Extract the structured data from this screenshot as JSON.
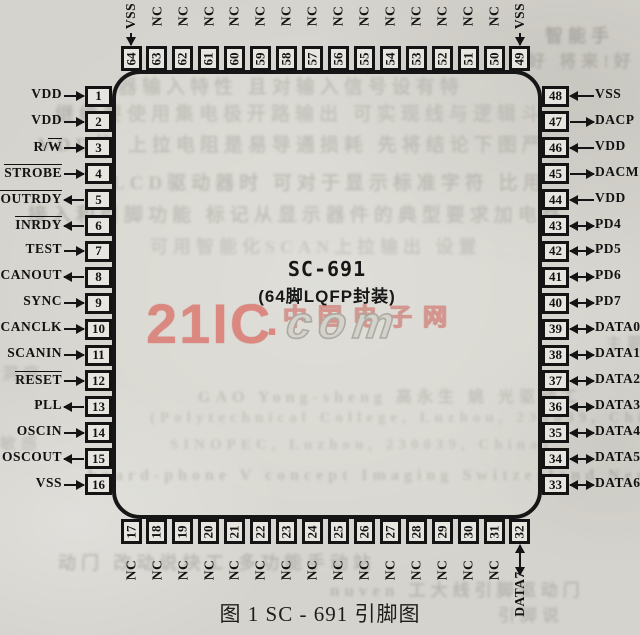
{
  "figure": {
    "chip_name": "SC-691",
    "package_label": "(64脚LQFP封装)",
    "caption": "图 1  SC - 691 引脚图"
  },
  "watermark": {
    "logo": "21IC",
    "dot": ".",
    "suffix": "com",
    "cn": "中国电子网",
    "red": "#d96a62",
    "gray": "#a5a39e"
  },
  "colors": {
    "paper": "#d5d3cd",
    "ink": "#141414",
    "pin_fill": "#e7e5df"
  },
  "pins": {
    "left": [
      {
        "num": "1",
        "pre": "VDD",
        "over": "",
        "dir": "in"
      },
      {
        "num": "2",
        "pre": "VDD",
        "over": "",
        "dir": "in"
      },
      {
        "num": "3",
        "pre": "R/",
        "over": "W",
        "dir": "in"
      },
      {
        "num": "4",
        "pre": "",
        "over": "STROBE",
        "dir": "in"
      },
      {
        "num": "5",
        "pre": "",
        "over": "OUTRDY",
        "dir": "out"
      },
      {
        "num": "6",
        "pre": "",
        "over": "INRDY",
        "dir": "out"
      },
      {
        "num": "7",
        "pre": "TEST",
        "over": "",
        "dir": "in"
      },
      {
        "num": "8",
        "pre": "SCANOUT",
        "over": "",
        "dir": "out"
      },
      {
        "num": "9",
        "pre": "SYNC",
        "over": "",
        "dir": "in"
      },
      {
        "num": "10",
        "pre": "SCANCLK",
        "over": "",
        "dir": "in"
      },
      {
        "num": "11",
        "pre": "SCANIN",
        "over": "",
        "dir": "in"
      },
      {
        "num": "12",
        "pre": "",
        "over": "RESET",
        "dir": "in"
      },
      {
        "num": "13",
        "pre": "PLL",
        "over": "",
        "dir": "out"
      },
      {
        "num": "14",
        "pre": "OSCIN",
        "over": "",
        "dir": "in"
      },
      {
        "num": "15",
        "pre": "OSCOUT",
        "over": "",
        "dir": "out"
      },
      {
        "num": "16",
        "pre": "VSS",
        "over": "",
        "dir": "in"
      }
    ],
    "right": [
      {
        "num": "48",
        "pre": "VSS",
        "over": "",
        "dir": "in"
      },
      {
        "num": "47",
        "pre": "DACP",
        "over": "",
        "dir": "out"
      },
      {
        "num": "46",
        "pre": "VDD",
        "over": "",
        "dir": "in"
      },
      {
        "num": "45",
        "pre": "DACM",
        "over": "",
        "dir": "out"
      },
      {
        "num": "44",
        "pre": "VDD",
        "over": "",
        "dir": "in"
      },
      {
        "num": "43",
        "pre": "PD4",
        "over": "",
        "dir": "bidir"
      },
      {
        "num": "42",
        "pre": "PD5",
        "over": "",
        "dir": "bidir"
      },
      {
        "num": "41",
        "pre": "PD6",
        "over": "",
        "dir": "bidir"
      },
      {
        "num": "40",
        "pre": "PD7",
        "over": "",
        "dir": "bidir"
      },
      {
        "num": "39",
        "pre": "DATA0",
        "over": "",
        "dir": "bidir"
      },
      {
        "num": "38",
        "pre": "DATA1",
        "over": "",
        "dir": "bidir"
      },
      {
        "num": "37",
        "pre": "DATA2",
        "over": "",
        "dir": "bidir"
      },
      {
        "num": "36",
        "pre": "DATA3",
        "over": "",
        "dir": "bidir"
      },
      {
        "num": "35",
        "pre": "DATA4",
        "over": "",
        "dir": "bidir"
      },
      {
        "num": "34",
        "pre": "DATA5",
        "over": "",
        "dir": "bidir"
      },
      {
        "num": "33",
        "pre": "DATA6",
        "over": "",
        "dir": "bidir"
      }
    ],
    "top": [
      {
        "num": "64",
        "pre": "VSS",
        "over": "",
        "dir": "in"
      },
      {
        "num": "63",
        "pre": "NC",
        "over": "",
        "dir": "none"
      },
      {
        "num": "62",
        "pre": "NC",
        "over": "",
        "dir": "none"
      },
      {
        "num": "61",
        "pre": "NC",
        "over": "",
        "dir": "none"
      },
      {
        "num": "60",
        "pre": "NC",
        "over": "",
        "dir": "none"
      },
      {
        "num": "59",
        "pre": "NC",
        "over": "",
        "dir": "none"
      },
      {
        "num": "58",
        "pre": "NC",
        "over": "",
        "dir": "none"
      },
      {
        "num": "57",
        "pre": "NC",
        "over": "",
        "dir": "none"
      },
      {
        "num": "56",
        "pre": "NC",
        "over": "",
        "dir": "none"
      },
      {
        "num": "55",
        "pre": "NC",
        "over": "",
        "dir": "none"
      },
      {
        "num": "54",
        "pre": "NC",
        "over": "",
        "dir": "none"
      },
      {
        "num": "53",
        "pre": "NC",
        "over": "",
        "dir": "none"
      },
      {
        "num": "52",
        "pre": "NC",
        "over": "",
        "dir": "none"
      },
      {
        "num": "51",
        "pre": "NC",
        "over": "",
        "dir": "none"
      },
      {
        "num": "50",
        "pre": "NC",
        "over": "",
        "dir": "none"
      },
      {
        "num": "49",
        "pre": "VSS",
        "over": "",
        "dir": "in"
      }
    ],
    "bottom": [
      {
        "num": "17",
        "pre": "NC",
        "over": "",
        "dir": "none"
      },
      {
        "num": "18",
        "pre": "NC",
        "over": "",
        "dir": "none"
      },
      {
        "num": "19",
        "pre": "NC",
        "over": "",
        "dir": "none"
      },
      {
        "num": "20",
        "pre": "NC",
        "over": "",
        "dir": "none"
      },
      {
        "num": "21",
        "pre": "NC",
        "over": "",
        "dir": "none"
      },
      {
        "num": "22",
        "pre": "NC",
        "over": "",
        "dir": "none"
      },
      {
        "num": "23",
        "pre": "NC",
        "over": "",
        "dir": "none"
      },
      {
        "num": "24",
        "pre": "NC",
        "over": "",
        "dir": "none"
      },
      {
        "num": "25",
        "pre": "NC",
        "over": "",
        "dir": "none"
      },
      {
        "num": "26",
        "pre": "NC",
        "over": "",
        "dir": "none"
      },
      {
        "num": "27",
        "pre": "NC",
        "over": "",
        "dir": "none"
      },
      {
        "num": "28",
        "pre": "NC",
        "over": "",
        "dir": "none"
      },
      {
        "num": "29",
        "pre": "NC",
        "over": "",
        "dir": "none"
      },
      {
        "num": "30",
        "pre": "NC",
        "over": "",
        "dir": "none"
      },
      {
        "num": "31",
        "pre": "NC",
        "over": "",
        "dir": "none"
      },
      {
        "num": "32",
        "pre": "DATA7",
        "over": "",
        "dir": "bidir"
      }
    ]
  },
  "bleedthrough": [
    {
      "t": "器输入特性 且对输入信号设有特",
      "x": 118,
      "y": 72,
      "s": 19,
      "o": 0.45
    },
    {
      "t": "继续要使用集电极开路输出 可实现线与逻辑斗",
      "x": 55,
      "y": 99,
      "s": 19,
      "o": 0.4
    },
    {
      "t": "VDD的 上拉电阻是易导通损耗 先将结论下图严",
      "x": 38,
      "y": 130,
      "s": 19,
      "o": 0.45
    },
    {
      "t": "LCD驱动器时 可对于显示标准字符 比用",
      "x": 112,
      "y": 168,
      "s": 19,
      "o": 0.5
    },
    {
      "t": "接入和引脚功能 标记从显示器件的典型要求加电路",
      "x": 28,
      "y": 200,
      "s": 19,
      "o": 0.45
    },
    {
      "t": "可用智能化SCAN上拉输出 设置",
      "x": 150,
      "y": 233,
      "s": 18,
      "o": 0.35
    },
    {
      "t": "GAO Yong-sheng 高永生 姚 光驱动工",
      "x": 198,
      "y": 383,
      "s": 16,
      "o": 0.42
    },
    {
      "t": "(Polytechnical College, Luzhou, 230039, China)",
      "x": 150,
      "y": 410,
      "s": 15,
      "o": 0.38
    },
    {
      "t": "SINOPEC, Luzhou, 230039, China)",
      "x": 170,
      "y": 437,
      "s": 15,
      "o": 0.38
    },
    {
      "t": "board-phone V concept Imaging Switzerland New",
      "x": 88,
      "y": 467,
      "s": 16,
      "o": 0.45
    },
    {
      "t": "动门 改动说块工 多功能手动站",
      "x": 58,
      "y": 549,
      "s": 18,
      "o": 0.4
    },
    {
      "t": "nuven 工大线引脚驱动门",
      "x": 330,
      "y": 576,
      "s": 17,
      "o": 0.4
    },
    {
      "t": "智能手",
      "x": 545,
      "y": 22,
      "s": 18,
      "o": 0.55
    },
    {
      "t": "好 将来!好",
      "x": 528,
      "y": 47,
      "s": 17,
      "o": 0.45
    },
    {
      "t": "洞庭",
      "x": 2,
      "y": 360,
      "s": 16,
      "o": 0.3
    },
    {
      "t": "敏感",
      "x": 0,
      "y": 430,
      "s": 16,
      "o": 0.28
    },
    {
      "t": "主要功",
      "x": 606,
      "y": 330,
      "s": 16,
      "o": 0.35
    },
    {
      "t": "引脚说",
      "x": 498,
      "y": 601,
      "s": 17,
      "o": 0.35
    }
  ]
}
